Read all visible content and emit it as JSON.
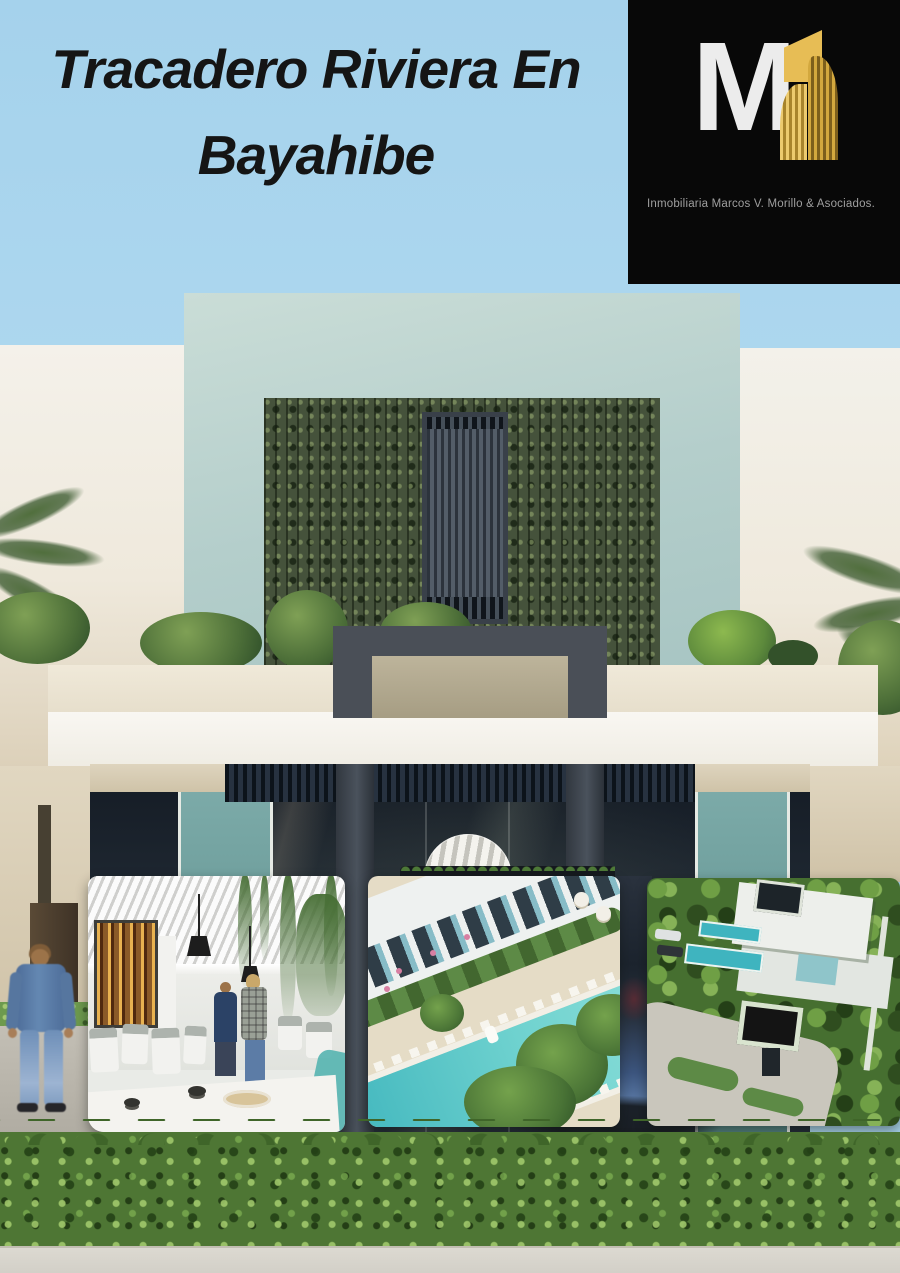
{
  "title": {
    "line1": "Tracadero Riviera En",
    "line2": "Bayahibe"
  },
  "logo": {
    "monogram": "M",
    "company": "Inmobiliaria Marcos V. Morillo & Asociados."
  },
  "photos": {
    "restaurant": {
      "label": "restaurant-interior-render"
    },
    "pool": {
      "label": "aerial-pool-render"
    },
    "villa": {
      "label": "aerial-villa-render"
    }
  },
  "colors": {
    "sky": "#a9d4ec",
    "title_text": "#151515",
    "logo_background": "#080808",
    "logo_gold": "#e3b54e",
    "logo_silver": "#ececec",
    "logo_text_gray": "#9f9f9f",
    "mint_wall": "#b4cecb",
    "green_living_wall": "#45523b",
    "canopy_white": "#f7f5ef",
    "glass_teal": "#70a1a0",
    "pool_teal": "#52c3c6",
    "hedge_green": "#4e7634",
    "path_gray": "#d8d5cd"
  }
}
